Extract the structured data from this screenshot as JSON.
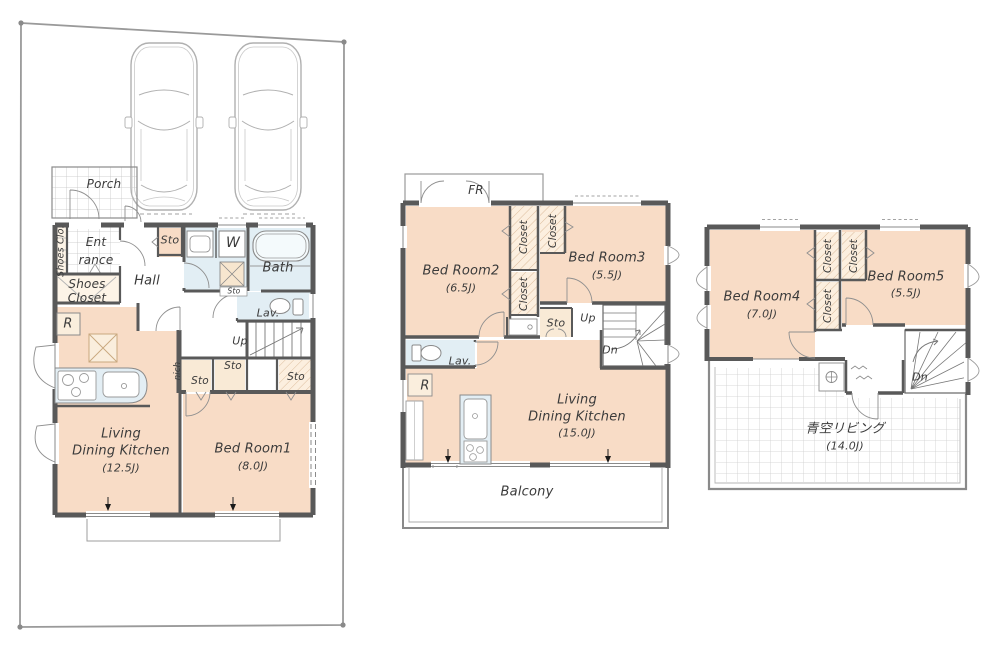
{
  "title": "3-storey house floor plan",
  "colors": {
    "room_fill": "#f8dcc6",
    "closet_fill": "#fcefdf",
    "wet_area_fill": "#e2eef4",
    "wall": "#595959",
    "fixture_line": "#8a8a8a",
    "site_line": "#9a9a9a",
    "text": "#3b3b3b"
  },
  "floor1": {
    "labels": {
      "porch": "Porch",
      "shoes_clo": "Shoes Clo.",
      "ent1": "Ent",
      "ent2": "rance",
      "shoes1": "Shoes",
      "shoes2": "Closet",
      "hall": "Hall",
      "sto_a": "Sto",
      "w": "W",
      "bath": "Bath",
      "sto_b": "Sto",
      "lav": "Lav.",
      "up": "Up",
      "nich": "nich",
      "sto_c": "Sto",
      "sto_d": "Sto",
      "sto_e": "Sto",
      "r": "R",
      "ldk1": "Living",
      "ldk2": "Dining Kitchen",
      "ldk_size": "(12.5J)",
      "bed1": "Bed Room1",
      "bed1_size": "(8.0J)"
    }
  },
  "floor2": {
    "labels": {
      "fr": "FR",
      "bed2": "Bed Room2",
      "bed2_size": "(6.5J)",
      "closet_a": "Closet",
      "closet_b": "Closet",
      "closet_c": "Closet",
      "bed3": "Bed Room3",
      "bed3_size": "(5.5J)",
      "sto": "Sto",
      "up": "Up",
      "dn": "Dn",
      "lav": "Lav.",
      "r": "R",
      "ldk1": "Living",
      "ldk2": "Dining Kitchen",
      "ldk_size": "(15.0J)",
      "balcony": "Balcony"
    }
  },
  "floor3": {
    "labels": {
      "bed4": "Bed Room4",
      "bed4_size": "(7.0J)",
      "closet_a": "Closet",
      "closet_b": "Closet",
      "closet_c": "Closet",
      "bed5": "Bed Room5",
      "bed5_size": "(5.5J)",
      "dn": "Dn",
      "sky": "青空リビング",
      "sky_size": "(14.0J)"
    }
  }
}
